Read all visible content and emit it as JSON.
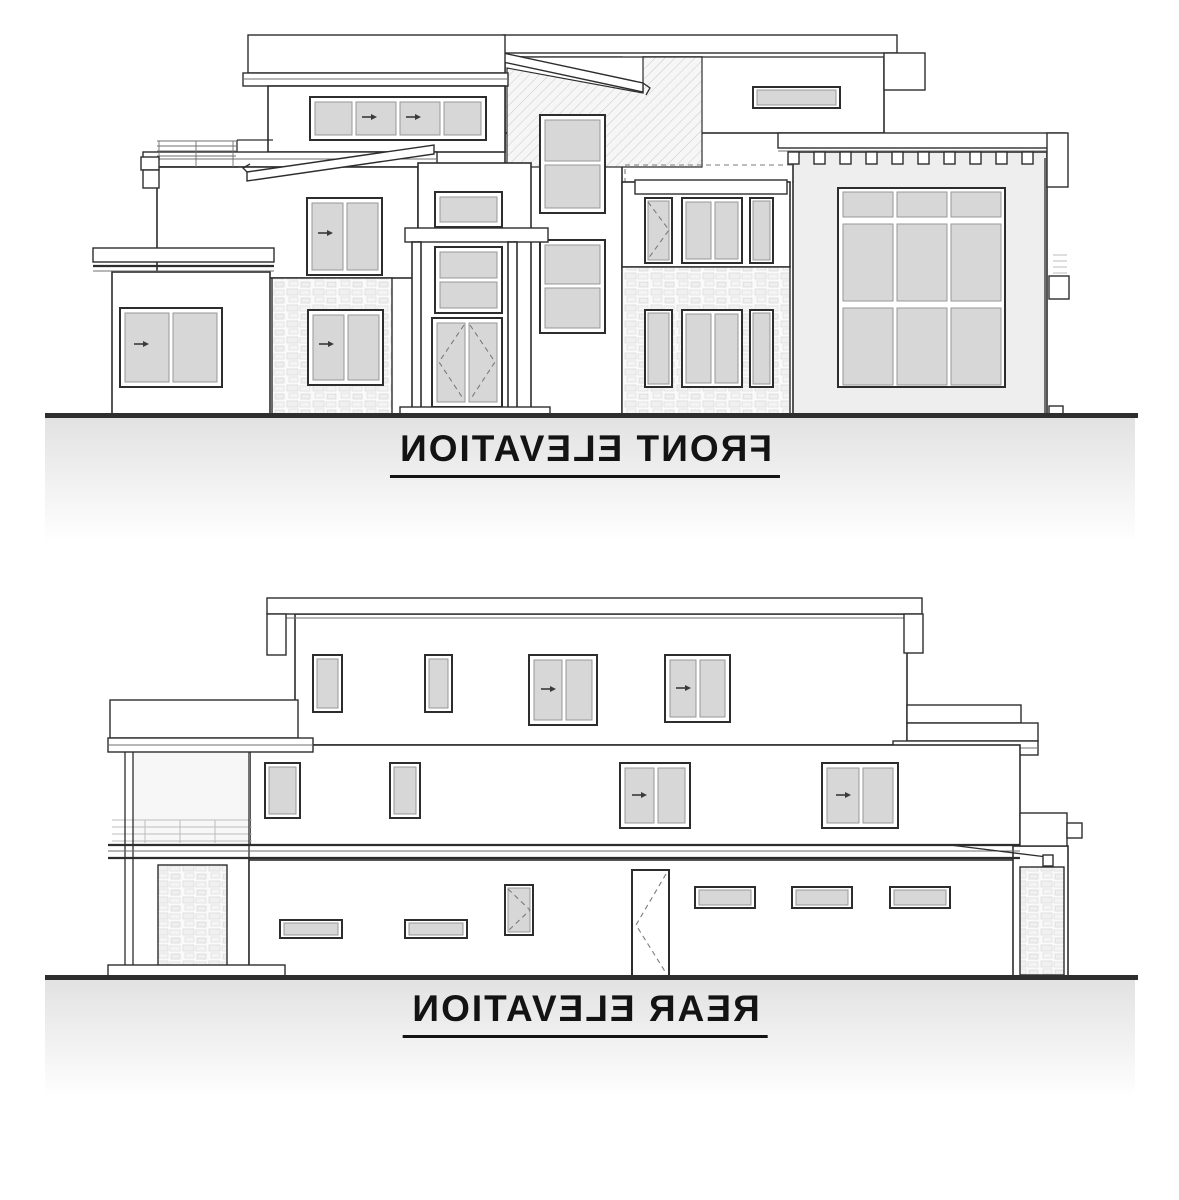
{
  "colors": {
    "line": "#2d2d2d",
    "glass": "#d7d7d7",
    "wall": "#ffffff",
    "garage_wall": "#eeeeee",
    "ground_line": "#2e2e2e",
    "ground_shade": "#e2e2e2",
    "label_text": "#131313"
  },
  "elevations": [
    {
      "id": "front",
      "label": "FRONT ELEVATION",
      "text_mirrored": true
    },
    {
      "id": "rear",
      "label": "REAR ELEVATION",
      "text_mirrored": true
    }
  ]
}
